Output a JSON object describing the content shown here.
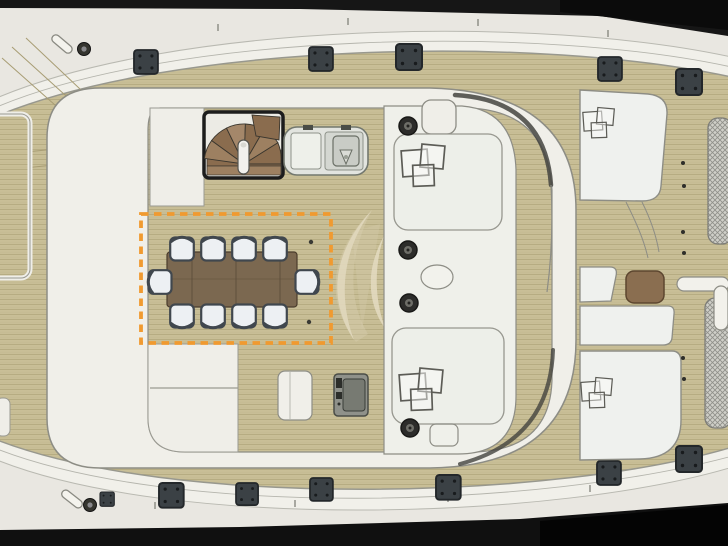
{
  "image": {
    "kind": "Catamaran flybridge deck plan",
    "style": "photographed printed plan, no visible text",
    "orientation": "bow-left"
  },
  "annotation": {
    "name": "dining-area-selection",
    "shape": "dashed-rectangle",
    "color": "#f09a30"
  },
  "palette": {
    "bezel_black": "#131313",
    "paper_white": "#e9e7e1",
    "hull_white": "#f1f0ea",
    "deck_wood": "#c9bf97",
    "plank_line": "#b3a87e",
    "structure_white": "#efeee8",
    "outline_gray": "#8d8d85",
    "hatch_dark": "#3b4145",
    "dining_table_wood": "#7b6850",
    "stair_wood": "#9a7c5d",
    "coffee_table_wood": "#8a6e50",
    "highlight_orange": "#f09a30"
  },
  "inventory": {
    "dining_seats": 10,
    "dining_tables": 1,
    "spiral_staircases": 1,
    "grill_stations": 1,
    "sunpad_cushion_icons": 4,
    "deck_hatches": 12,
    "speaker_ports": 4,
    "mesh_grates": 2,
    "coffee_tables": 1,
    "cleats": 2
  }
}
